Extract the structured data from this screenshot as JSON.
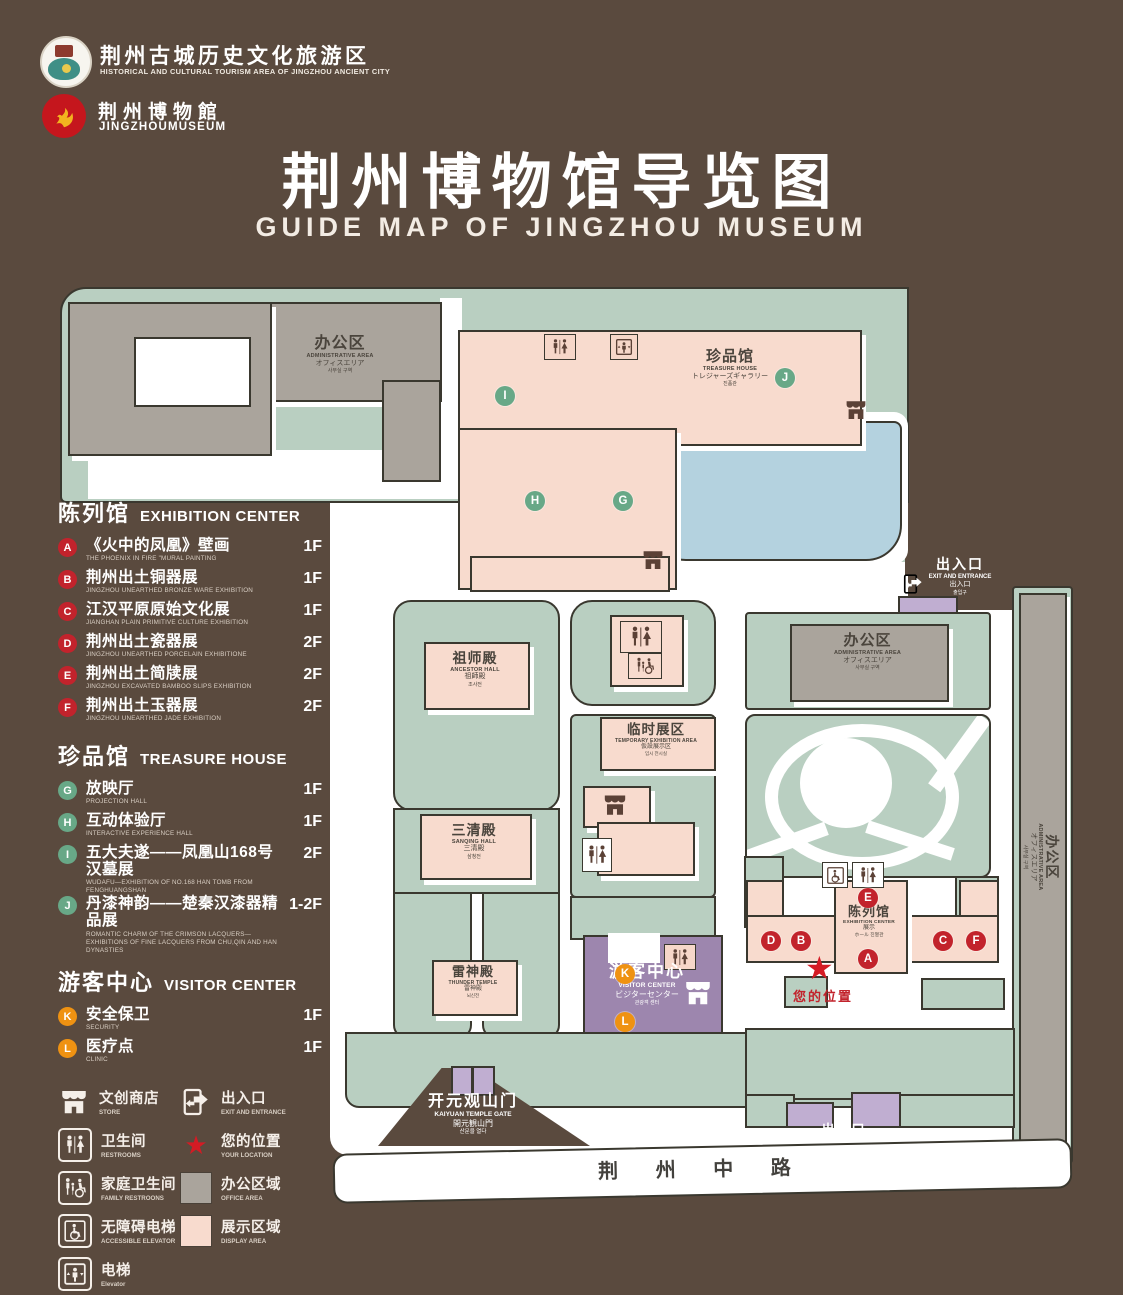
{
  "header": {
    "tourism_cn": "荆州古城历史文化旅游区",
    "tourism_en": "HISTORICAL AND CULTURAL TOURISM AREA OF JINGZHOU ANCIENT CITY",
    "museum_cn": "荆州博物館",
    "museum_en": "JINGZHOUMUSEUM",
    "title": "荆州博物馆导览图",
    "subtitle": "GUIDE MAP OF JINGZHOU MUSEUM"
  },
  "legend": {
    "sections": [
      {
        "title_cn": "陈列馆",
        "title_en": "EXHIBITION CENTER",
        "items": [
          {
            "code": "A",
            "cn": "《火中的凤凰》壁画",
            "en": "THE PHOENIX IN FIRE \"MURAL PAINTING",
            "floor": "1F"
          },
          {
            "code": "B",
            "cn": "荆州出土铜器展",
            "en": "JINGZHOU UNEARTHED BRONZE WARE EXHIBITION",
            "floor": "1F"
          },
          {
            "code": "C",
            "cn": "江汉平原原始文化展",
            "en": "JIANGHAN PLAIN PRIMITIVE CULTURE EXHIBITION",
            "floor": "1F"
          },
          {
            "code": "D",
            "cn": "荆州出土瓷器展",
            "en": "JINGZHOU UNEARTHED PORCELAIN EXHIBITIONE",
            "floor": "2F"
          },
          {
            "code": "E",
            "cn": "荆州出土简牍展",
            "en": "JINGZHOU EXCAVATED BAMBOO SLIPS EXHIBITION",
            "floor": "2F"
          },
          {
            "code": "F",
            "cn": "荆州出土玉器展",
            "en": "JINGZHOU UNEARTHED JADE EXHIBITION",
            "floor": "2F"
          }
        ]
      },
      {
        "title_cn": "珍品馆",
        "title_en": "TREASURE HOUSE",
        "items": [
          {
            "code": "G",
            "cn": "放映厅",
            "en": "PROJECTION HALL",
            "floor": "1F"
          },
          {
            "code": "H",
            "cn": "互动体验厅",
            "en": "INTERACTIVE EXPERIENCE HALL",
            "floor": "1F"
          },
          {
            "code": "I",
            "cn": "五大夫遂——凤凰山168号汉墓展",
            "en": "WUDAFU—EXHIBITION OF NO.168 HAN TOMB FROM FENGHUANGSHAN",
            "floor": "2F"
          },
          {
            "code": "J",
            "cn": "丹漆神韵——楚秦汉漆器精品展",
            "en": "ROMANTIC CHARM OF THE CRIMSON LACQUERS—EXHIBITIONS OF FINE LACQUERS FROM CHU,QIN AND HAN DYNASTIES",
            "floor": "1-2F"
          }
        ]
      },
      {
        "title_cn": "游客中心",
        "title_en": "VISITOR CENTER",
        "items": [
          {
            "code": "K",
            "cn": "安全保卫",
            "en": "SECURITY",
            "floor": "1F"
          },
          {
            "code": "L",
            "cn": "医疗点",
            "en": "CLINIC",
            "floor": "1F"
          }
        ]
      }
    ],
    "symbols": [
      {
        "cn": "文创商店",
        "en": "STORE"
      },
      {
        "cn": "卫生间",
        "en": "RESTROOMS"
      },
      {
        "cn": "家庭卫生间",
        "en": "FAMILY RESTROONS"
      },
      {
        "cn": "无障碍电梯",
        "en": "ACCESSIBLE ELEVATOR"
      },
      {
        "cn": "电梯",
        "en": "Elevator"
      },
      {
        "cn": "出入口",
        "en": "EXIT AND ENTRANCE"
      },
      {
        "cn": "您的位置",
        "en": "YOUR LOCATION"
      },
      {
        "cn": "办公区域",
        "en": "OFFICE AREA"
      },
      {
        "cn": "展示区域",
        "en": "DISPLAY AREA"
      }
    ]
  },
  "map": {
    "admin": {
      "cn": "办公区",
      "en": "ADMINISTRATIVE AREA",
      "jp": "オフィスエリア",
      "kr": "사무실 구역"
    },
    "treasure": {
      "cn": "珍品馆",
      "en": "TREASURE HOUSE",
      "jp": "トレジャーズギャラリー",
      "kr": "진품관"
    },
    "ancestor": {
      "cn": "祖师殿",
      "en": "ANCESTOR HALL",
      "jp": "祖師殿",
      "kr": "조사전"
    },
    "sanqing": {
      "cn": "三清殿",
      "en": "SANQING HALL",
      "jp": "三清殿",
      "kr": "삼청전"
    },
    "temporary": {
      "cn": "临时展区",
      "en": "TEMPORARY EXHIBITION AREA",
      "jp": "仮設展示区",
      "kr": "임시 전시실"
    },
    "thunder": {
      "cn": "雷神殿",
      "en": "THUNDER TEMPLE",
      "jp": "雷神殿",
      "kr": "뇌신전"
    },
    "visitor": {
      "cn": "游客中心",
      "en": "VISITOR CENTER",
      "jp": "ビジターセンター",
      "kr": "관광객 센터"
    },
    "exhibition": {
      "cn": "陈列馆",
      "en": "EXHIBITION CENTER",
      "jp": "展示",
      "kr": "ホール 진열관"
    },
    "gate": {
      "cn": "开元观山门",
      "en": "KAIYUAN TEMPLE GATE",
      "jp": "開元観山門",
      "kr": "산문을 열다"
    },
    "exit": {
      "cn": "出入口",
      "en": "EXIT AND ENTRANCE",
      "sub": "出入口",
      "kr": "출입구"
    },
    "road": "荆 州 中 路",
    "your_location": "您的位置",
    "star": "★",
    "markers": {
      "treasure": [
        "I",
        "J",
        "H",
        "G"
      ],
      "exhibition": [
        "E",
        "D",
        "B",
        "C",
        "F",
        "A"
      ],
      "visitor": [
        "K",
        "L"
      ]
    }
  },
  "colors": {
    "background": "#5a4a3e",
    "lawn": "#b9cfc1",
    "display_area": "#f8dbce",
    "office_area": "#aaa49c",
    "visitor_purple": "#9d86ae",
    "gate_purple": "#c0aed1",
    "pond": "#b4d2df",
    "marker_red": "#c2232c",
    "marker_green": "#68a887",
    "marker_orange": "#ef9212"
  }
}
